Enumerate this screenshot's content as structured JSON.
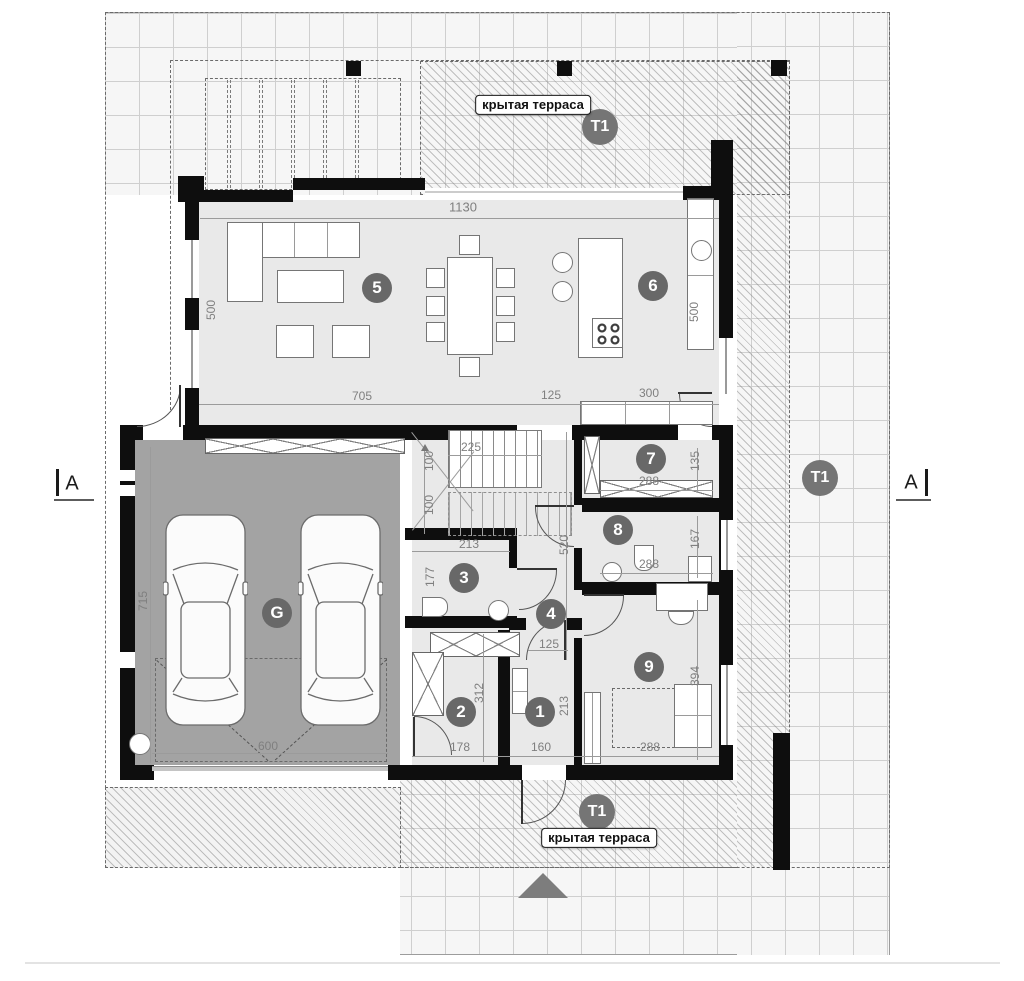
{
  "labels": {
    "covered_terrace": "крытая терраса",
    "t1": "T1",
    "section": "A"
  },
  "badges": {
    "entry": "1",
    "utility": "2",
    "wc": "3",
    "hall": "4",
    "living": "5",
    "kitchen": "6",
    "pantry": "7",
    "bath": "8",
    "bedroom": "9",
    "garage": "G"
  },
  "dimensions": {
    "top_width": "1130",
    "living_left_height": "500",
    "kitchen_right_height": "500",
    "living_width": "705",
    "passage_width": "125",
    "kitchen_counter_width": "300",
    "garage_height": "715",
    "garage_door_width": "600",
    "stairs_width": "225",
    "stairs_flight_a": "100",
    "stairs_flight_b": "100",
    "wc_width": "213",
    "hall_height": "520",
    "wc_height": "177",
    "pantry_width": "288",
    "pantry_height": "135",
    "bath_width": "288",
    "bath_height": "167",
    "bedroom_height": "394",
    "bedroom_width": "288",
    "utility_height": "312",
    "utility_width": "178",
    "entry_door_width": "125",
    "entry_width": "160",
    "entry_height": "213"
  },
  "colors": {
    "wall": "#0e0e0e",
    "room_fill": "#e9e9e9",
    "garage_fill": "#a3a3a3",
    "badge_bg": "#686868",
    "terrace_badge_bg": "#757575",
    "dim_text": "#7f7f7f"
  }
}
